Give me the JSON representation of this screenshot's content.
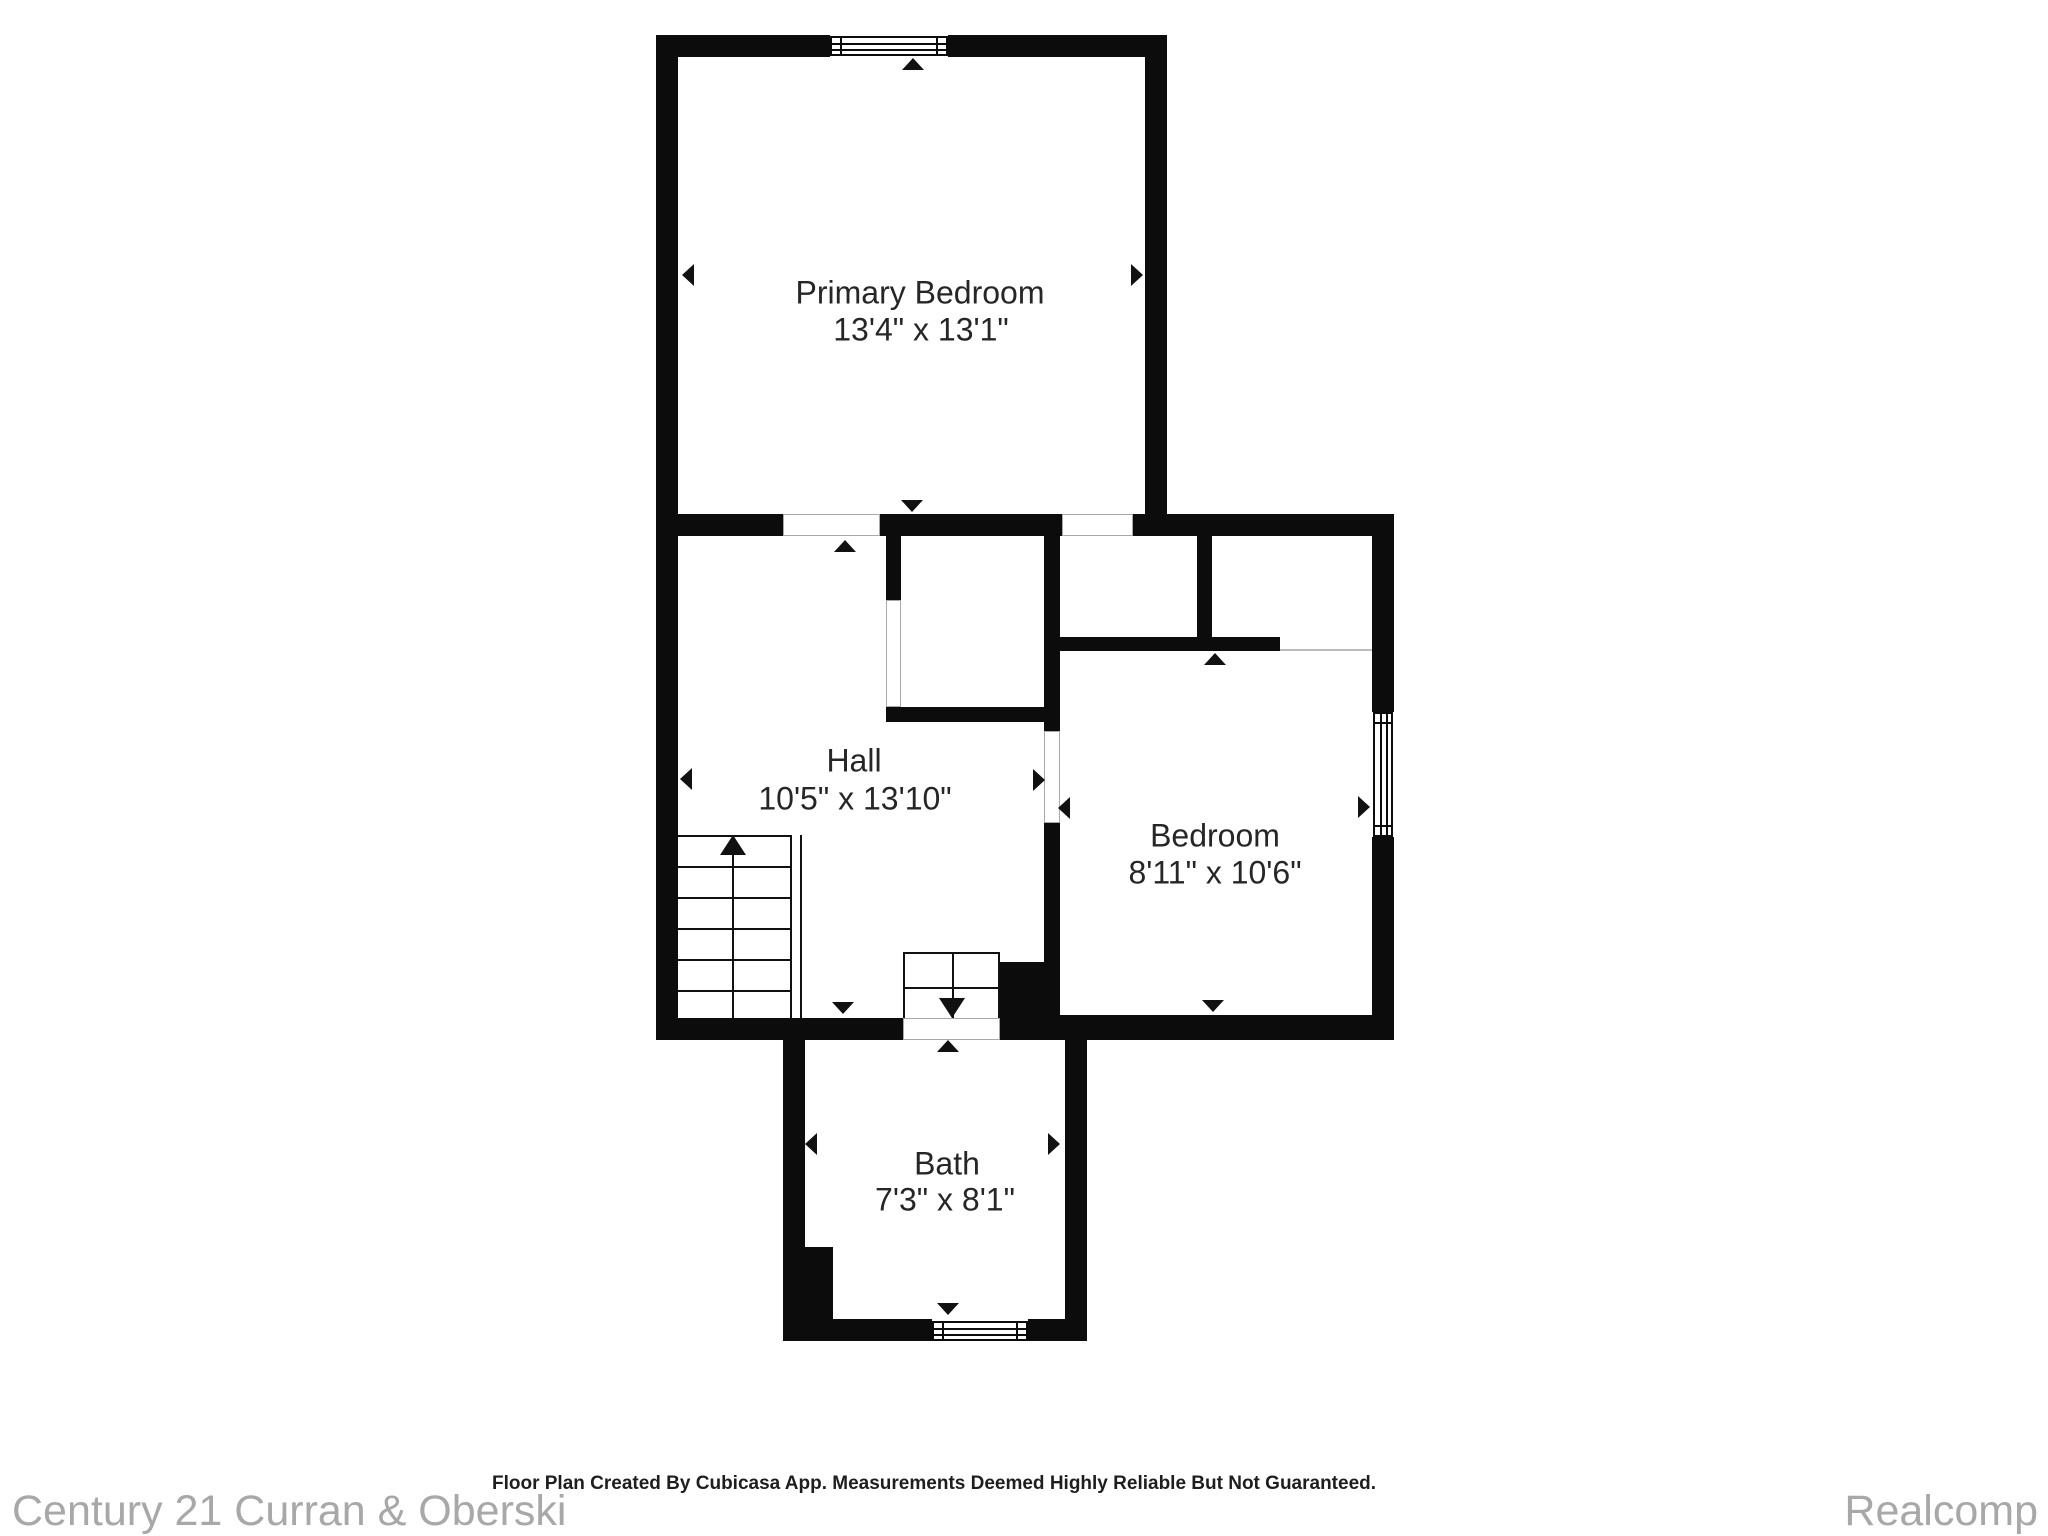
{
  "floor_plan": {
    "rooms": [
      {
        "name": "Primary Bedroom",
        "dimensions": "13'4\" x 13'1\""
      },
      {
        "name": "Hall",
        "dimensions": "10'5\" x 13'10\""
      },
      {
        "name": "Bedroom",
        "dimensions": "8'11\" x 10'6\""
      },
      {
        "name": "Bath",
        "dimensions": "7'3\" x 8'1\""
      }
    ],
    "features": {
      "windows": 3,
      "staircases": [
        "stairs-up",
        "stairs-down"
      ]
    }
  },
  "footer": {
    "left_brand": "Century 21 Curran & Oberski",
    "disclaimer": "Floor Plan Created By Cubicasa App. Measurements Deemed Highly Reliable But Not Guaranteed.",
    "right_brand": "Realcomp"
  },
  "colors": {
    "wall": "#0c0c0c",
    "room_text": "#262626",
    "brand_text": "#a8a8a8",
    "background": "#ffffff"
  }
}
